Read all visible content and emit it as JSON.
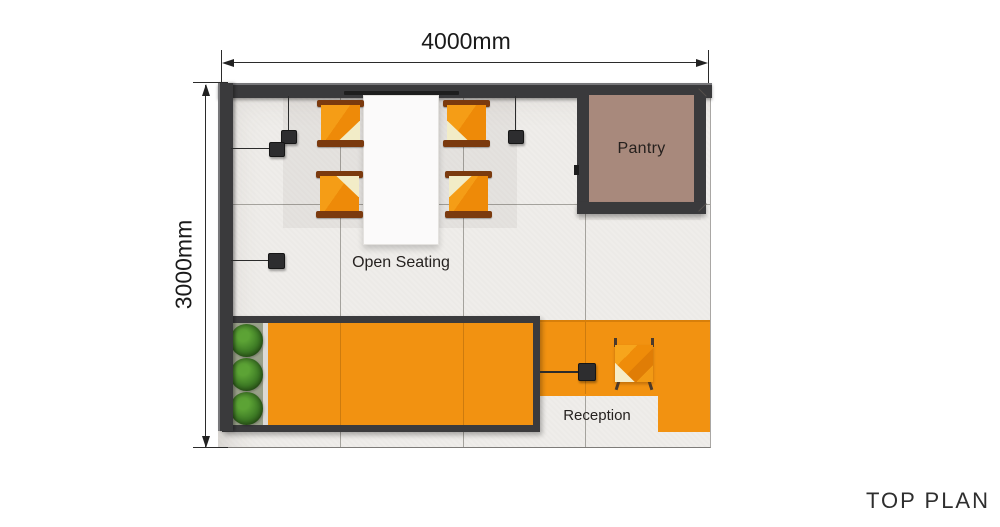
{
  "page": {
    "title": "TOP PLAN"
  },
  "dimensions": {
    "width": {
      "label": "4000mm"
    },
    "height": {
      "label": "3000mm"
    }
  },
  "zones": {
    "open_seating": {
      "label": "Open Seating"
    },
    "pantry": {
      "label": "Pantry"
    },
    "reception": {
      "label": "Reception"
    }
  },
  "furniture": {
    "dining_table": 1,
    "dining_chairs": 4,
    "reception_chair": 1,
    "reception_desk": 1,
    "plants": 3,
    "pendant_lights": 5
  },
  "colors": {
    "wall": "#3a3a3c",
    "floor": "#efedea",
    "accent_orange": "#f29211",
    "pantry_floor": "#a8897c",
    "chair_orange": "#f08c0c",
    "cushion_cream": "#f2ecc7",
    "plant_green": "#3f7d26",
    "planter_bed": "#99a089",
    "text": "#1f1f1f"
  }
}
